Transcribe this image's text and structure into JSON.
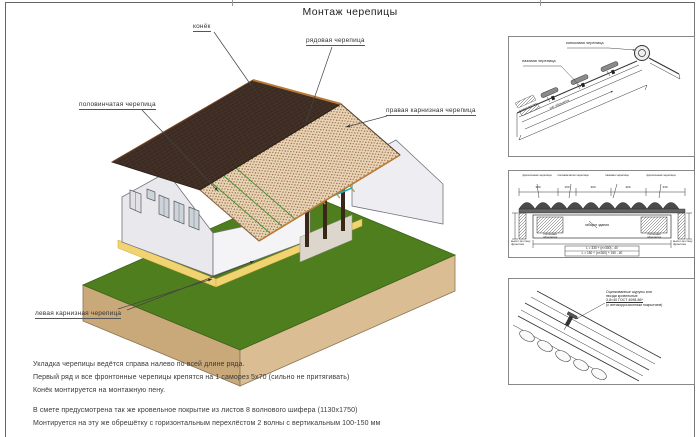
{
  "title": "Монтаж черепицы",
  "drawing_labels": {
    "ridge": "конёк",
    "row_tile": "рядовая черепица",
    "half_tile": "половинчатая черепица",
    "right_eave_tile": "правая карнизная черепица",
    "left_eave_tile": "левая карнизная черепица"
  },
  "notes_block1": [
    "Укладка черепицы ведётся справа налево по всей длине ряда.",
    "Первый ряд и все фронтонные черепицы крепятся на 1 саморез 5х70 (сильно не притягивать)",
    "Конёк монтируется на монтажную пену."
  ],
  "notes_block2": [
    "В смете предусмотрена так же кровельное покрытие из листов 8 волнового шифера (1130х1750)",
    "Монтируется на эту же обрешётку с горизонтальным перехлёстом 2 волны с вертикальным 100-150 мм"
  ],
  "panel_top": {
    "label_ridge_tile": "коньковая черепица",
    "label_groove_tile": "пазовая черепица",
    "dim_label": "шаг обрешётки"
  },
  "panel_middle": {
    "col_labels": [
      "фронтонная черепица",
      "половинчатая черепица",
      "пазовая черепица",
      "фронтонная черепица"
    ],
    "dims": [
      "330",
      "150",
      "300",
      "300",
      "330"
    ],
    "center_label": "габарит здания",
    "left_label": "вылет за стену фронтона",
    "right_label": "вылет за стену фронтона",
    "hatch_label_left": "сплошная обрешётка",
    "hatch_label_right": "сплошная обрешётка",
    "formulas": [
      "L = 330 + (n×300) - 40",
      "L = 150 + (n×300) + 150 - 40"
    ]
  },
  "panel_bottom": {
    "note_lines": [
      "Оцинкованные шурупы или",
      "гвозди кровельные",
      "3,8×40 ГОСТ 4098-86*",
      "(с антикоррозионным покрытием)"
    ]
  },
  "colors": {
    "roof_dark": "#3c2b22",
    "roof_light": "#e9d6b9",
    "lawn": "#4e7e1e",
    "earth": "#cfae82",
    "accent_beam": "#12b4c8",
    "blind_area": "#f2d371"
  }
}
